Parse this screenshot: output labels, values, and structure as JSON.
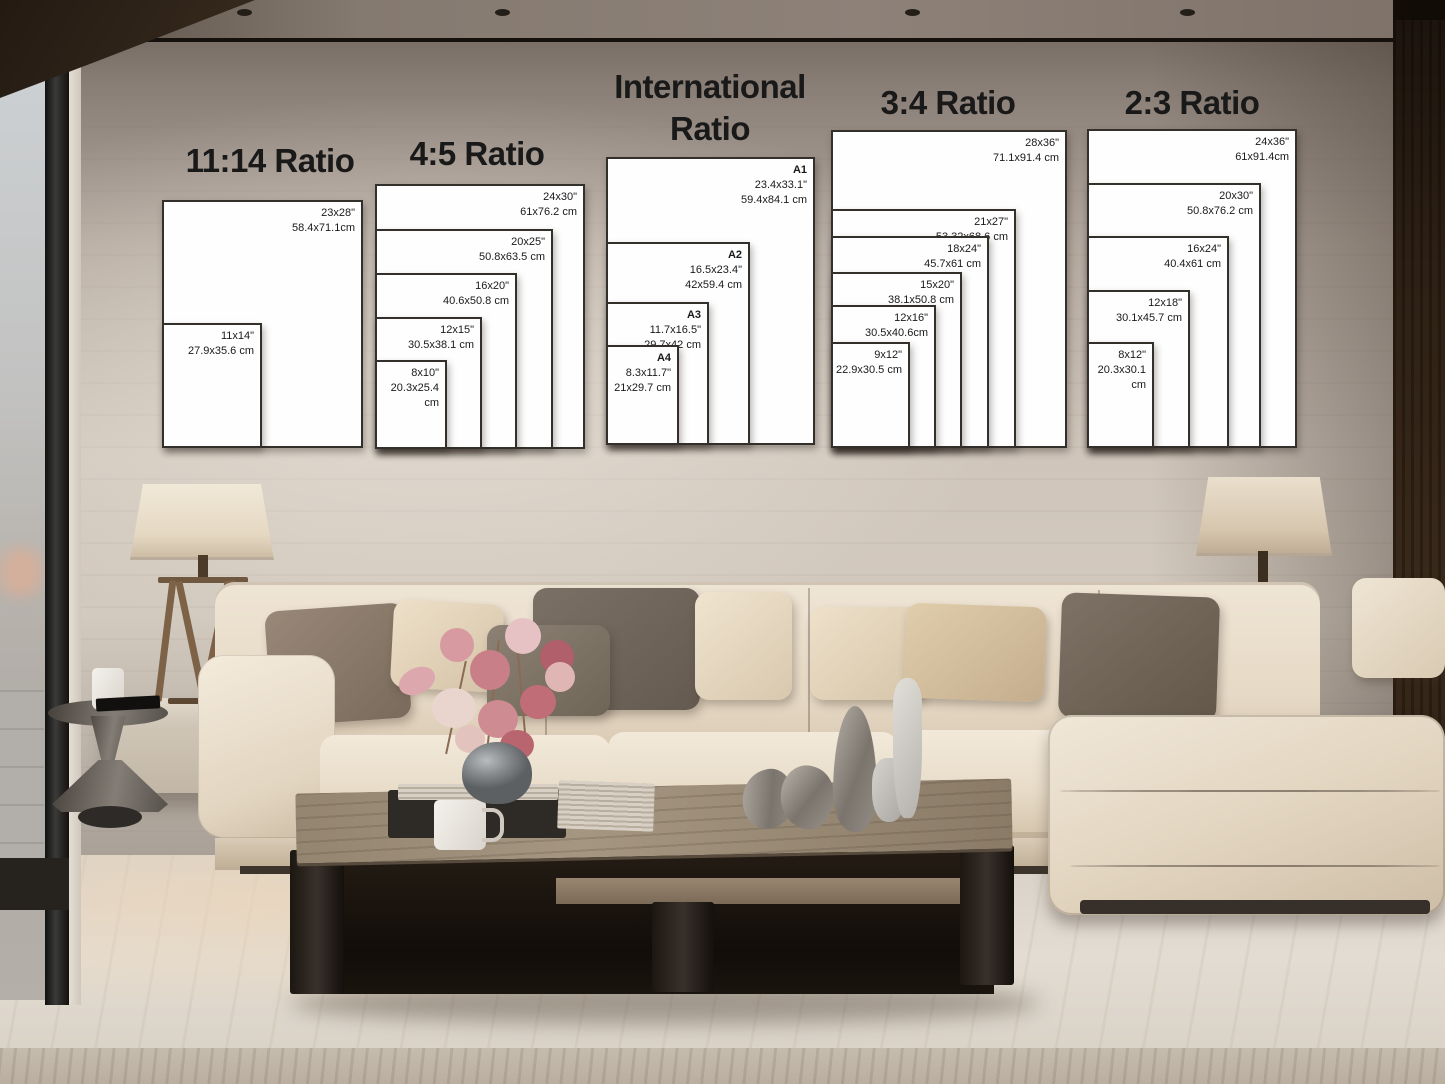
{
  "poster_guide": {
    "groups": [
      {
        "title": "11:14 Ratio",
        "frames": [
          {
            "size_in": "23x28\"",
            "size_cm": "58.4x71.1cm"
          },
          {
            "size_in": "11x14\"",
            "size_cm": "27.9x35.6 cm"
          }
        ]
      },
      {
        "title": "4:5 Ratio",
        "frames": [
          {
            "size_in": "24x30\"",
            "size_cm": "61x76.2 cm"
          },
          {
            "size_in": "20x25\"",
            "size_cm": "50.8x63.5 cm"
          },
          {
            "size_in": "16x20\"",
            "size_cm": "40.6x50.8 cm"
          },
          {
            "size_in": "12x15\"",
            "size_cm": "30.5x38.1 cm"
          },
          {
            "size_in": "8x10\"",
            "size_cm": "20.3x25.4 cm"
          }
        ]
      },
      {
        "title_line1": "International",
        "title_line2": "Ratio",
        "frames": [
          {
            "name": "A1",
            "size_in": "23.4x33.1\"",
            "size_cm": "59.4x84.1 cm"
          },
          {
            "name": "A2",
            "size_in": "16.5x23.4\"",
            "size_cm": "42x59.4 cm"
          },
          {
            "name": "A3",
            "size_in": "11.7x16.5\"",
            "size_cm": "29.7x42 cm"
          },
          {
            "name": "A4",
            "size_in": "8.3x11.7\"",
            "size_cm": "21x29.7 cm"
          }
        ]
      },
      {
        "title": "3:4 Ratio",
        "frames": [
          {
            "size_in": "28x36\"",
            "size_cm": "71.1x91.4 cm"
          },
          {
            "size_in": "21x27\"",
            "size_cm": "53.32x68.6 cm"
          },
          {
            "size_in": "18x24\"",
            "size_cm": "45.7x61 cm"
          },
          {
            "size_in": "15x20\"",
            "size_cm": "38.1x50.8 cm"
          },
          {
            "size_in": "12x16\"",
            "size_cm": "30.5x40.6cm"
          },
          {
            "size_in": "9x12\"",
            "size_cm": "22.9x30.5 cm"
          }
        ]
      },
      {
        "title": "2:3 Ratio",
        "frames": [
          {
            "size_in": "24x36\"",
            "size_cm": "61x91.4cm"
          },
          {
            "size_in": "20x30\"",
            "size_cm": "50.8x76.2 cm"
          },
          {
            "size_in": "16x24\"",
            "size_cm": "40.4x61 cm"
          },
          {
            "size_in": "12x18\"",
            "size_cm": "30.1x45.7 cm"
          },
          {
            "size_in": "8x12\"",
            "size_cm": "20.3x30.1 cm"
          }
        ]
      }
    ]
  },
  "colors": {
    "frame_background": "#fefefe",
    "frame_border": "#33302c",
    "title_text": "#191919",
    "label_text": "#1a1a1a",
    "wall_light": "#cfc5bb",
    "sofa_cream": "#e9dcc8",
    "pillow_taupe": "#8a7a69",
    "flower_pink": "#cf8b92",
    "wood_panel_dark": "#2e2014"
  }
}
